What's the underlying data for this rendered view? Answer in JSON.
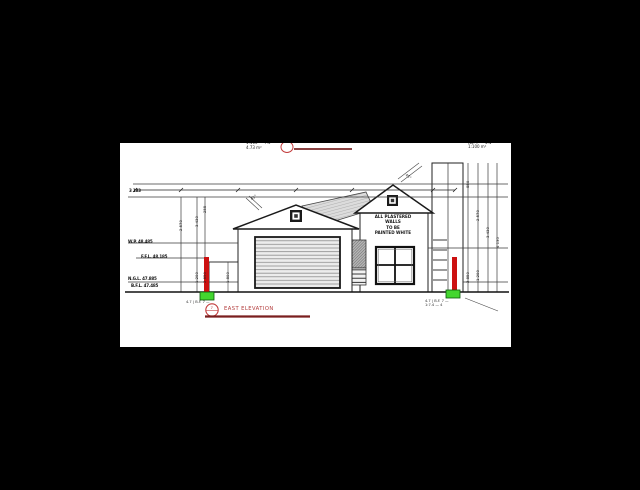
{
  "colors": {
    "background": "#000000",
    "sheet": "#ffffff",
    "line": "#333333",
    "column_red": "#cc1111",
    "marker_green": "#43d62f",
    "title_red": "#b23a3a",
    "underline_red": "#7a1f1f"
  },
  "drawing": {
    "title": "EAST ELEVATION",
    "title_bubble_label": "7",
    "gable_note_lines": [
      "ALL PLASTERED",
      "WALLS",
      "TO BE",
      "PAINTED WHITE"
    ],
    "top_left_note_lines": [
      "1:100 — 7.4",
      "4.73 m²"
    ],
    "top_right_note_lines": [
      "No. 7 — 4.1",
      "1:100 m²"
    ],
    "level_labels": [
      "3 183",
      "W.P. 48.485",
      "F.F.L. 48.185",
      "N.G.L. 47.885",
      "B.F.L. 47.485"
    ],
    "left_dim_labels": [
      "2 570",
      "3 430",
      "255",
      "2 850",
      "1 200",
      "1 800"
    ],
    "right_dim_labels": [
      "850",
      "2 570",
      "3 430",
      "4 130",
      "2 850",
      "1 200"
    ],
    "slope_label_left": "45°",
    "slope_label_right": "45°",
    "marker_note_left": "4.7 | B.F. 7 —",
    "marker_note_right_lines": [
      "4.7 | B.F. 7 —",
      "1:7.4 — 4"
    ]
  }
}
